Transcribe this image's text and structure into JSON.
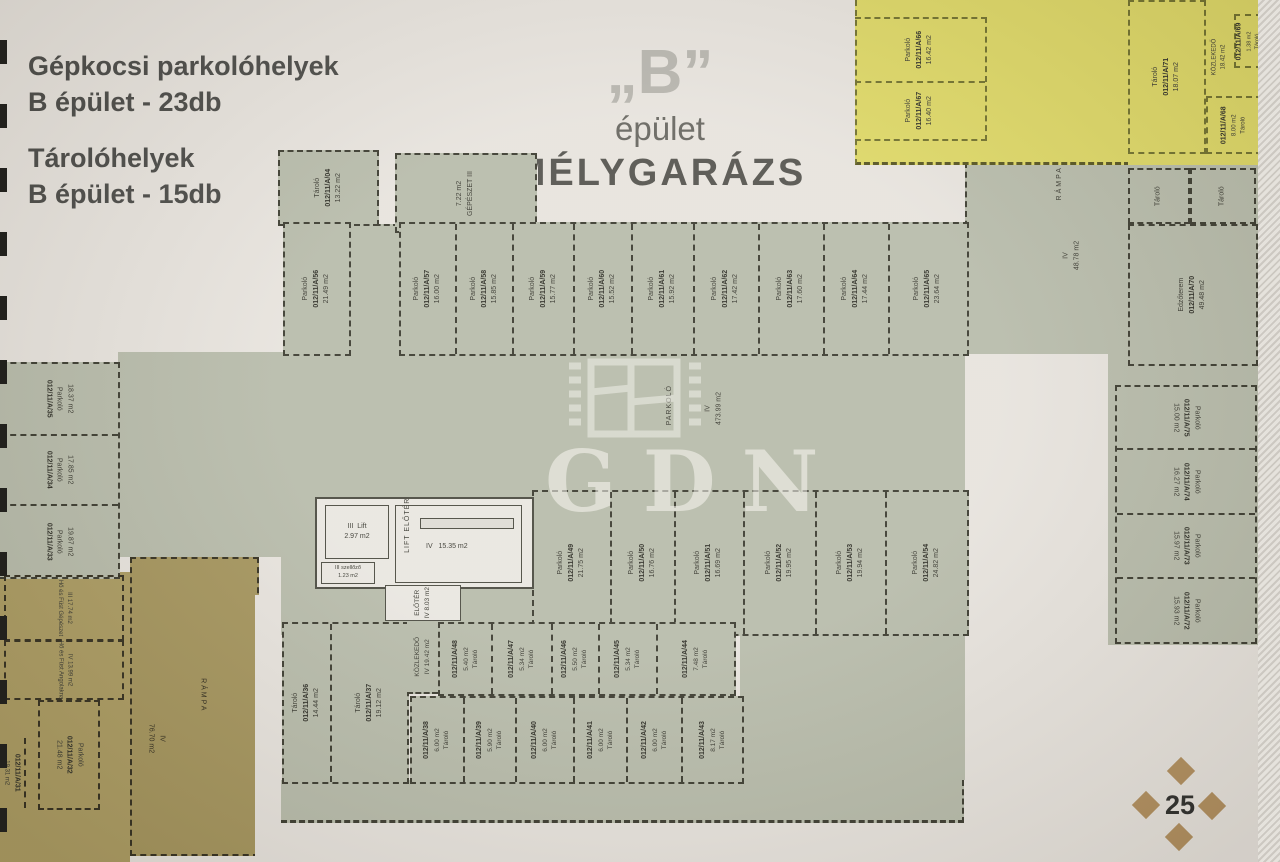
{
  "legend": {
    "line1": "Gépkocsi parkolóhelyek",
    "line2": "B épület - 23db",
    "line3": "Tárolóhelyek",
    "line4": "B épület - 15db"
  },
  "title": {
    "quote": "„B”",
    "line2": "épület",
    "line3": "MÉLYGARÁZS"
  },
  "watermark": {
    "text": "GDN"
  },
  "footer": {
    "page_number": "25"
  },
  "colors": {
    "sage": "#b7bbaa",
    "yellow": "#ddd765",
    "gold": "#ab9b61",
    "paper": "#e7e3dd",
    "diamond": "#b18f5e"
  },
  "areas": {
    "main": {
      "name": "PARKOLÓ",
      "floor": "IV",
      "area": "473.99 m2"
    },
    "ramp_left": {
      "name": "RÁMPA",
      "floor": "IV",
      "area": "76.70 m2"
    },
    "ramp_right": {
      "name": "RÁMPA",
      "floor": "IV",
      "area": "48.78 m2"
    }
  },
  "stalls": {
    "top_row_first": {
      "type": "Parkoló",
      "id": "012/11/A/56",
      "area": "21.49 m2"
    },
    "top_row": [
      {
        "type": "Parkoló",
        "id": "012/11/A/57",
        "area": "16.00 m2",
        "w": 56
      },
      {
        "type": "Parkoló",
        "id": "012/11/A/58",
        "area": "15.85 m2",
        "w": 57
      },
      {
        "type": "Parkoló",
        "id": "012/11/A/59",
        "area": "15.77 m2",
        "w": 60
      },
      {
        "type": "Parkoló",
        "id": "012/11/A/60",
        "area": "15.52 m2",
        "w": 58
      },
      {
        "type": "Parkoló",
        "id": "012/11/A/61",
        "area": "15.92 m2",
        "w": 62
      },
      {
        "type": "Parkoló",
        "id": "012/11/A/62",
        "area": "17.42 m2",
        "w": 65
      },
      {
        "type": "Parkoló",
        "id": "012/11/A/63",
        "area": "17.60 m2",
        "w": 65
      },
      {
        "type": "Parkoló",
        "id": "012/11/A/64",
        "area": "17.44 m2",
        "w": 65
      },
      {
        "type": "Parkoló",
        "id": "012/11/A/65",
        "area": "23.64 m2",
        "w": 80
      }
    ],
    "middle_row": [
      {
        "type": "Parkoló",
        "id": "012/11/A/49",
        "area": "21.75 m2",
        "w": 78
      },
      {
        "type": "Parkoló",
        "id": "012/11/A/50",
        "area": "16.76 m2",
        "w": 64
      },
      {
        "type": "Parkoló",
        "id": "012/11/A/51",
        "area": "16.69 m2",
        "w": 69
      },
      {
        "type": "Parkoló",
        "id": "012/11/A/52",
        "area": "19.95 m2",
        "w": 72
      },
      {
        "type": "Parkoló",
        "id": "012/11/A/53",
        "area": "19.94 m2",
        "w": 71
      },
      {
        "type": "Parkoló",
        "id": "012/11/A/54",
        "area": "24.82 m2",
        "w": 82
      }
    ],
    "left_column": [
      {
        "type": "Parkoló",
        "id": "012/11/A/35",
        "area": "18.37 m2",
        "w": 71
      },
      {
        "type": "Parkoló",
        "id": "012/11/A/34",
        "area": "17.85 m2",
        "w": 70
      },
      {
        "type": "Parkoló",
        "id": "012/11/A/33",
        "area": "19.87 m2",
        "w": 72
      }
    ],
    "right_column": [
      {
        "type": "Parkoló",
        "id": "012/11/A/75",
        "area": "15.00 m2",
        "w": 62
      },
      {
        "type": "Parkoló",
        "id": "012/11/A/74",
        "area": "16.27 m2",
        "w": 65
      },
      {
        "type": "Parkoló",
        "id": "012/11/A/73",
        "area": "15.97 m2",
        "w": 63
      },
      {
        "type": "Parkoló",
        "id": "012/11/A/72",
        "area": "15.93 m2",
        "w": 65
      }
    ],
    "yellow_row": [
      {
        "type": "Parkoló",
        "id": "012/11/A/66",
        "area": "16.42 m2",
        "w": 63
      },
      {
        "type": "Parkoló",
        "id": "012/11/A/67",
        "area": "16.40 m2",
        "w": 57
      }
    ],
    "left_edge": {
      "type": "Parkoló",
      "id": "012/11/A/31",
      "area": "19.31 m2"
    },
    "gold_parking": {
      "type": "Parkoló",
      "id": "012/11/A/32",
      "area": "21.48 m2"
    }
  },
  "storage": {
    "tall": [
      {
        "type": "Tároló",
        "id": "012/11/A/36",
        "area": "14.44 m2",
        "w": 46
      },
      {
        "type": "Tároló",
        "id": "012/11/A/37",
        "area": "19.12 m2",
        "w": 75
      }
    ],
    "row1": [
      {
        "type": "Tároló",
        "id": "012/11/A/48",
        "area": "5.40 m2",
        "w": 50
      },
      {
        "type": "Tároló",
        "id": "012/11/A/47",
        "area": "5.34 m2",
        "w": 57
      },
      {
        "type": "Tároló",
        "id": "012/11/A/46",
        "area": "5.50 m2",
        "w": 44
      },
      {
        "type": "Tároló",
        "id": "012/11/A/45",
        "area": "5.34 m2",
        "w": 55
      },
      {
        "type": "Tároló",
        "id": "012/11/A/44",
        "area": "7.48 m2",
        "w": 75
      }
    ],
    "row2": [
      {
        "type": "Tároló",
        "id": "012/11/A/38",
        "area": "6.00 m2",
        "w": 52
      },
      {
        "type": "Tároló",
        "id": "012/11/A/39",
        "area": "5.90 m2",
        "w": 52
      },
      {
        "type": "Tároló",
        "id": "012/11/A/40",
        "area": "6.00 m2",
        "w": 57
      },
      {
        "type": "Tároló",
        "id": "012/11/A/41",
        "area": "6.00 m2",
        "w": 52
      },
      {
        "type": "Tároló",
        "id": "012/11/A/42",
        "area": "6.00 m2",
        "w": 55
      },
      {
        "type": "Tároló",
        "id": "012/11/A/43",
        "area": "8.17 m2",
        "w": 60
      }
    ],
    "kozlekedo": {
      "name": "KÖZLEKEDŐ",
      "floor": "IV",
      "area": "19.42 m2"
    }
  },
  "rooms": {
    "tarolo_tl": {
      "type": "Tároló",
      "id": "012/11/A/04",
      "area": "13.22 m2"
    },
    "gepeszet": {
      "name": "GÉPÉSZET",
      "floor": "III",
      "area": "7.22 m2"
    },
    "lift": {
      "name": "Lift",
      "floor": "III",
      "area": "2.97 m2"
    },
    "szellozo": {
      "name": "szellőző",
      "floor": "III",
      "area": "1.23 m2"
    },
    "lift_eloter": {
      "name": "LIFT ELŐTÉR",
      "floor": "IV",
      "area": "15.35 m2"
    },
    "eloter": {
      "name": "ELŐTÉR",
      "floor": "IV",
      "area": "8.03 m2"
    },
    "ho_gepeszet": {
      "floor": "III",
      "area": "17.74 m2",
      "name": "Hő és Füst Gépészet"
    },
    "ho_akna": {
      "floor": "IV",
      "area": "13.99 m2",
      "name": "Hő és Füst Angolakna"
    },
    "edzoterem": {
      "name": "Edzőterem",
      "id": "012/11/A/70",
      "area": "49.48 m2"
    },
    "tarolo_r1": {
      "type": "Tároló"
    },
    "tarolo_r2": {
      "type": "Tároló"
    },
    "y_tarolo_big": {
      "type": "Tároló",
      "id": "012/11/A/71",
      "area": "18.07 m2"
    },
    "y_kozlekedo": {
      "name": "KÖZLEKEDŐ",
      "area": "18.42 m2"
    },
    "y_tarolo_small": {
      "type": "Tároló",
      "id": "012/11/A/69",
      "area": "1.38 m2"
    },
    "y_tarolo_8": {
      "type": "Tároló",
      "id": "012/11/A/68",
      "area": "8.00 m2"
    }
  }
}
